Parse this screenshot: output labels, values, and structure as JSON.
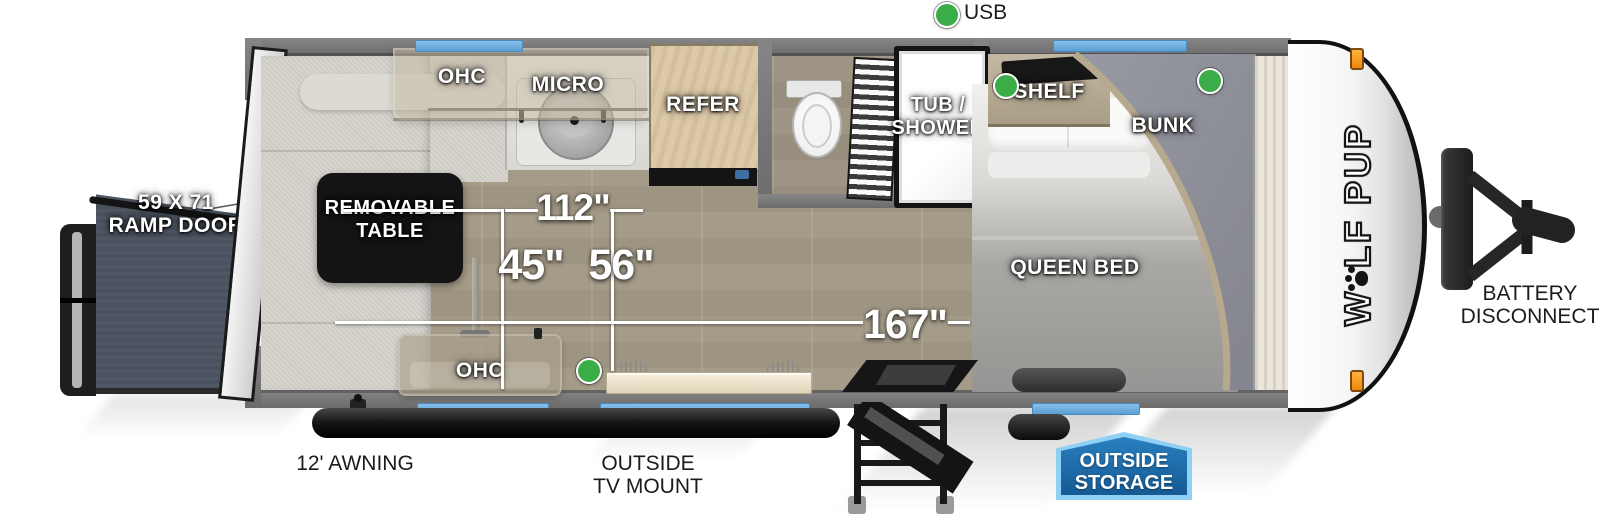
{
  "legend": {
    "usb": "USB"
  },
  "brand": {
    "prefix": "W",
    "suffix": "LF PUP"
  },
  "rooms": {
    "ramp_door": [
      "59 X 71",
      "RAMP DOOR"
    ],
    "removable_table": [
      "REMOVABLE",
      "TABLE"
    ],
    "ohc_rear": "OHC",
    "micro": "MICRO",
    "refer": "REFER",
    "tub_shower": [
      "TUB /",
      "SHOWER"
    ],
    "shelf": "SHELF",
    "bunk": "BUNK",
    "queen_bed": "QUEEN BED",
    "ohc_front": "OHC"
  },
  "dimensions": {
    "galley_run": "112\"",
    "sofa_depth": "45\"",
    "aisle_width": "56\"",
    "interior_length": "167\""
  },
  "exterior": {
    "awning": "12' AWNING",
    "tv_mount": [
      "OUTSIDE",
      "TV MOUNT"
    ],
    "outside_storage": [
      "OUTSIDE",
      "STORAGE"
    ],
    "battery_disconnect": [
      "BATTERY",
      "DISCONNECT"
    ]
  },
  "colors": {
    "window_blue": "#6fb1e2",
    "usb_indicator_green": "#3bad48",
    "storage_badge_blue": "#1c6fb2",
    "storage_badge_border": "#8ed1f5",
    "clearance_light_orange": "#f09010",
    "ramp_door_gray": "#49525e",
    "bunk_fabric_gray": "#8d8e97",
    "wall_gray": "#6e6e6e"
  }
}
